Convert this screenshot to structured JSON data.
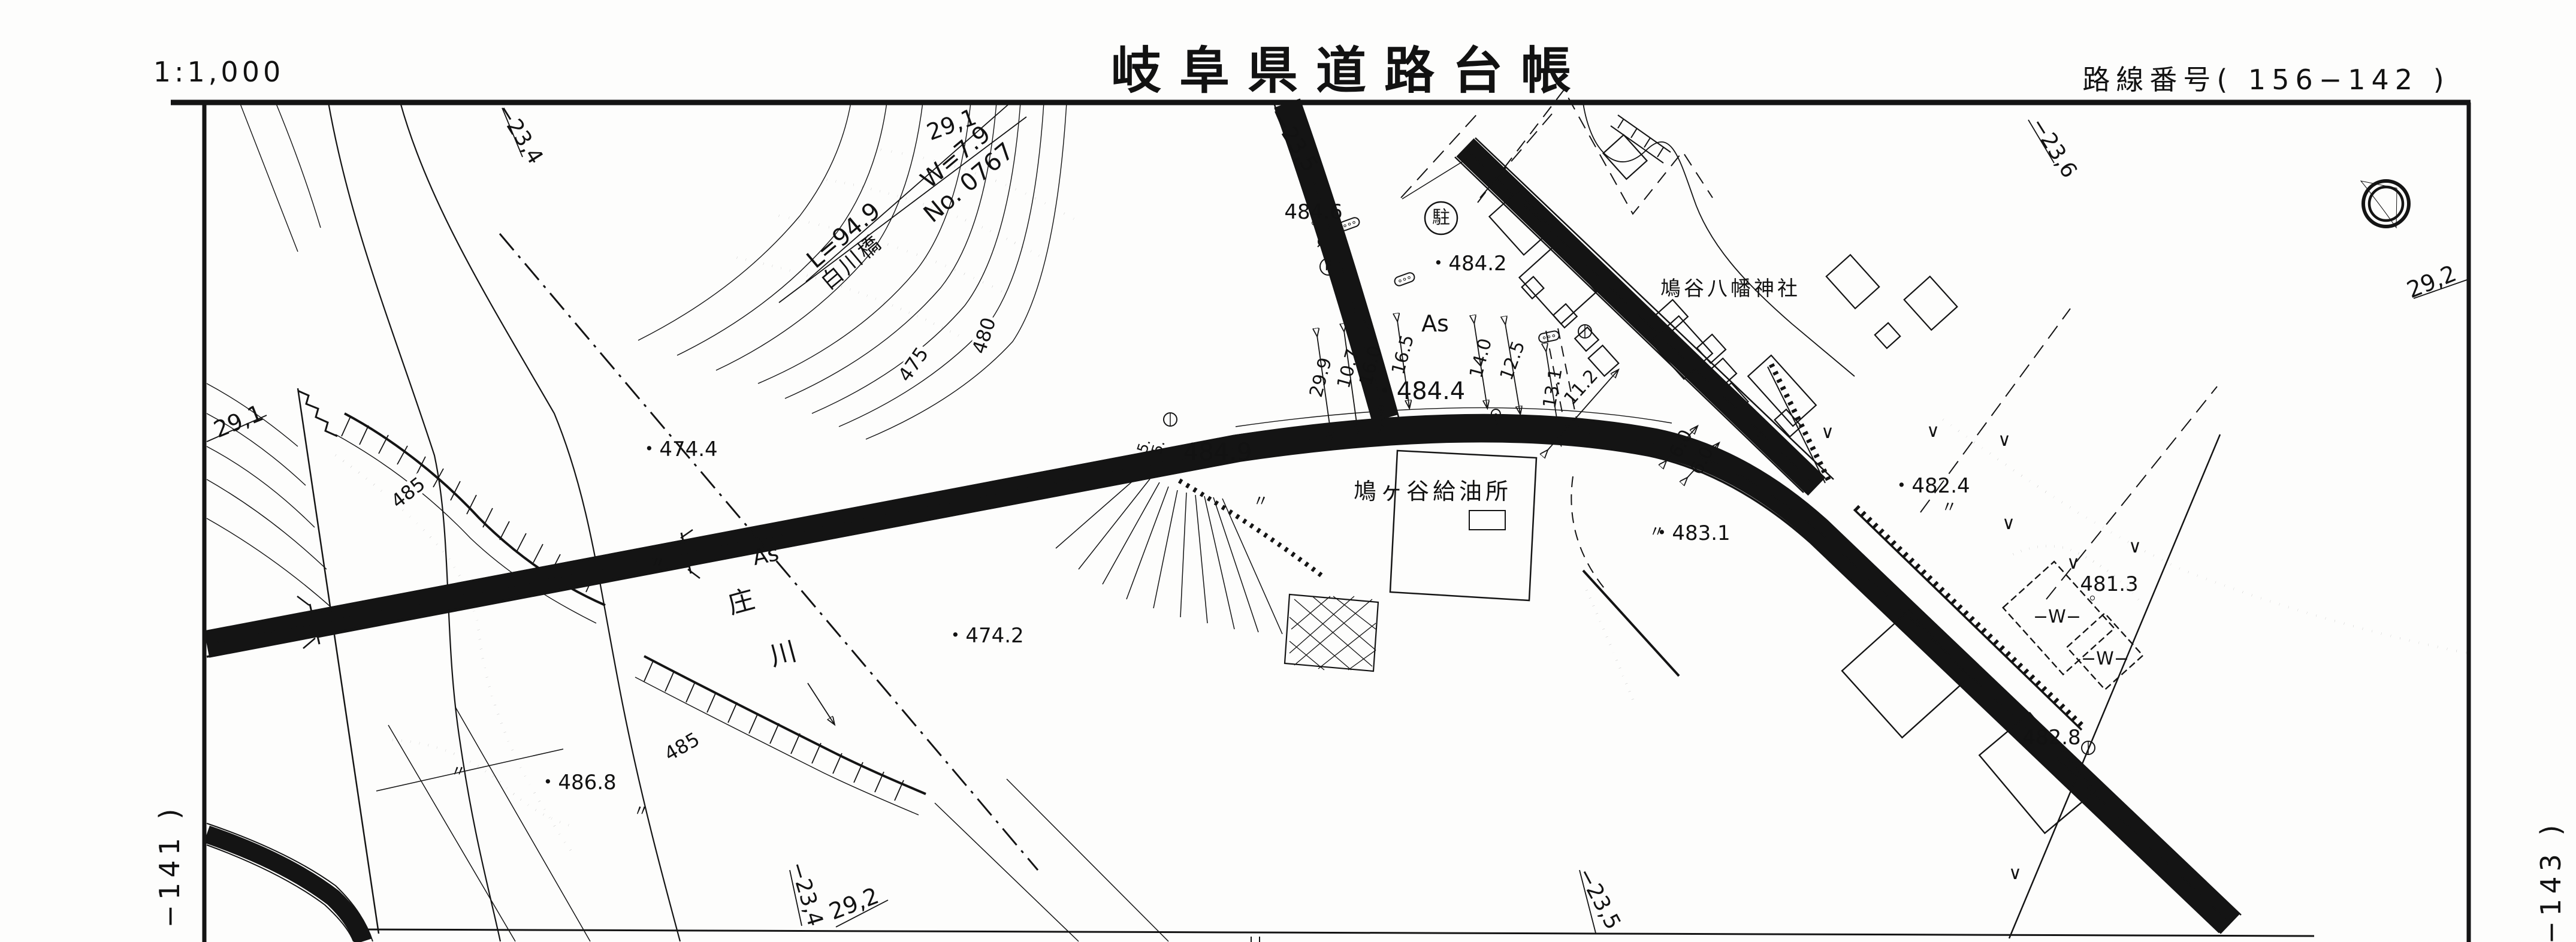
{
  "header": {
    "scale": "1:1,000",
    "title": "岐阜県道路台帳",
    "route": "路線番号( 156−142 )"
  },
  "sheet_refs": {
    "left": "29,1",
    "top_right": "29,2",
    "top_a": "−23,4",
    "top_b": "−23,5",
    "top_c": "−23,6",
    "bottom_a": "−23,4",
    "bottom_b": "29,2",
    "bottom_c": "−23,5",
    "corner_left": "−141 )",
    "corner_right": "−143 )"
  },
  "bridge": {
    "station": "29,1",
    "width": "W=7.9",
    "number": "No. 0767",
    "length": "L=94.9",
    "name": "白川橋"
  },
  "river": {
    "char1": "庄",
    "char2": "川"
  },
  "contours": {
    "c475": "475",
    "c480": "480",
    "c485a": "485",
    "c485b": "485"
  },
  "elevations": {
    "p474_4": "・474.4",
    "p474_2": "・474.2",
    "p486_8": "・486.8",
    "p484_6": "484.6",
    "p484_9": "484.9",
    "p484_4": "・484.4",
    "p484_2": "・484.2",
    "p483_1": "・483.1",
    "p482_4": "・482.4",
    "p481_3": "481.3",
    "p482_8": "482.8"
  },
  "features": {
    "parking": "駐",
    "f_mark": "F",
    "gas_station": "鳩ヶ谷給油所",
    "shrine": "鳩谷八幡神社",
    "surface_left": "As",
    "surface_center": "As",
    "water1": "−W−",
    "water2": "−W−"
  },
  "measurements": {
    "m29_9": "29.9",
    "m10_7": "10.7",
    "m16_0": "16.0",
    "m16_5": "16.5",
    "m14_0": "14.0",
    "m12_5": "12.5",
    "m13_1": "13.1",
    "m11_2": "11.2",
    "m6_0a": "6.0",
    "m6_0b": "6.0",
    "m5a": "5.",
    "m5b": "5."
  },
  "marks": {
    "ditto": "〃",
    "veg": "∨"
  }
}
